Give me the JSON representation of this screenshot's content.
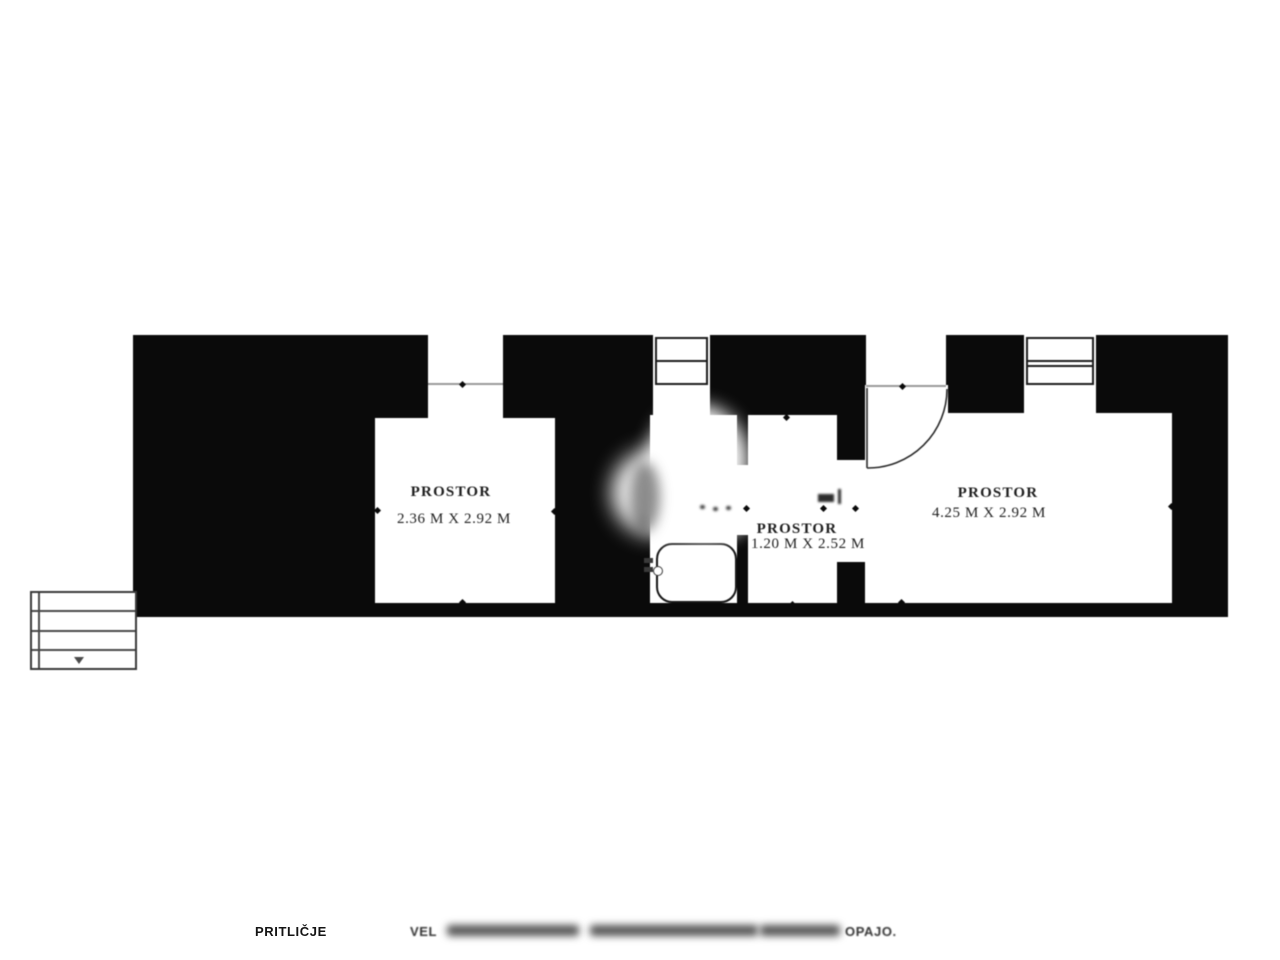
{
  "document": {
    "type": "scanned floor plan",
    "colors": {
      "wall": "#0a0a0a",
      "background": "#ffffff",
      "line": "#2a2a2a"
    }
  },
  "plan": {
    "rooms": [
      {
        "name": "PROSTOR",
        "dimensions": "2.36 M X 2.92 M"
      },
      {
        "name": "PROSTOR",
        "dimensions": "1.20 M X 2.52 M"
      },
      {
        "name": "PROSTOR",
        "dimensions": "4.25 M X 2.92 M"
      }
    ],
    "icons": {
      "window": "rect-with-horizontal-bars",
      "door_swing": "quarter-circle-arc",
      "bathtub": "rounded-rect",
      "stairs": "stepped-lines-with-down-arrow",
      "dimension_tick": "small-rotated-square"
    }
  },
  "footer": {
    "floor_label": "PRITLIČJE",
    "caption_start": "VEL",
    "caption_end": "OPAJO."
  }
}
